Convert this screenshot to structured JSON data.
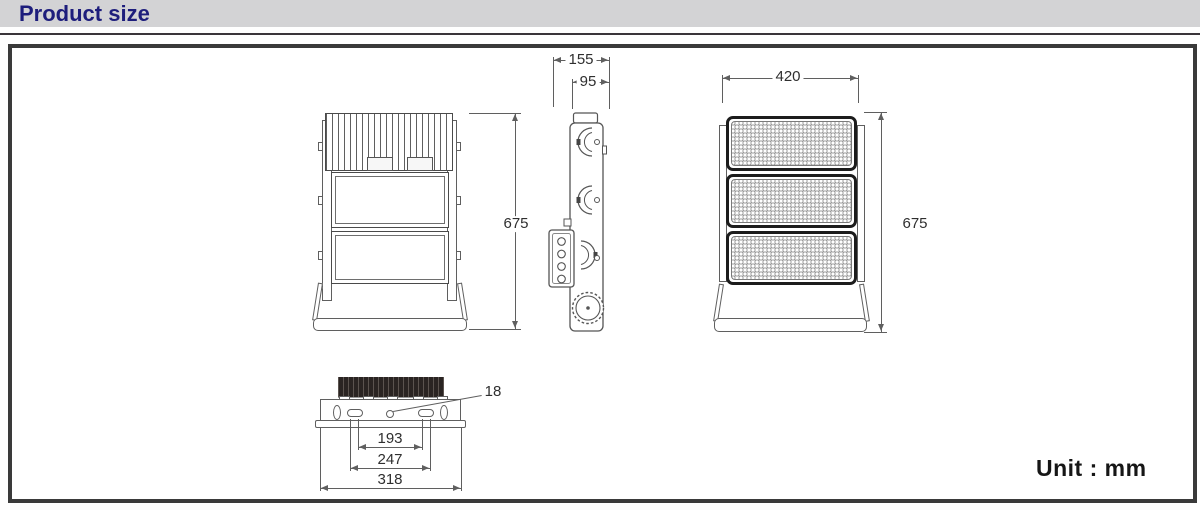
{
  "header": {
    "title": "Product size"
  },
  "footer": {
    "unit_text": "Unit : mm"
  },
  "colors": {
    "canvas_bg": "#ffffff",
    "header_bar_bg": "#d3d3d5",
    "title_navy": "#1d1d7c",
    "rule_dark": "#3a353a",
    "frame_border": "#3a3a3a",
    "line_gray": "#5f5f5f",
    "module_black": "#1c1c1c",
    "led_ring": "#9b9b9b",
    "heatsink_dark": "#2a2422",
    "dim_text": "#2f2f2f"
  },
  "diagram": {
    "dims": {
      "side_overall_depth": "155",
      "side_body_depth": "95",
      "front_width": "420",
      "rear_height": "675",
      "front_height": "675",
      "mount_hole_dia": "18",
      "mount_pitch_inner": "193",
      "mount_pitch_outer": "247",
      "mount_overall_width": "318"
    }
  }
}
